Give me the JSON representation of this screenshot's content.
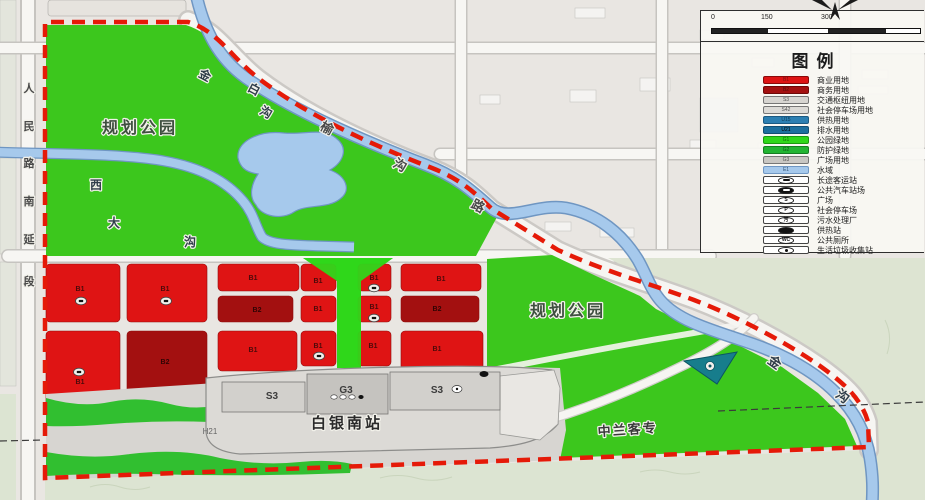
{
  "legend": {
    "title": "图例",
    "land_items": [
      {
        "code": "B1",
        "label": "商业用地",
        "color": "#dd1414",
        "border": "#8a0a0a",
        "text": "#7a1212"
      },
      {
        "code": "B2",
        "label": "商务用地",
        "color": "#a31010",
        "border": "#6d0808",
        "text": "#540a0a"
      },
      {
        "code": "S3",
        "label": "交通枢纽用地",
        "color": "#d7d5d1",
        "border": "#777777",
        "text": "#555555"
      },
      {
        "code": "S42",
        "label": "社会停车场用地",
        "color": "#dcdad6",
        "border": "#777777",
        "text": "#555555"
      },
      {
        "code": "U15",
        "label": "供热用地",
        "color": "#2c7fb2",
        "border": "#1b5a82",
        "text": "#0d3c58"
      },
      {
        "code": "U21",
        "label": "排水用地",
        "color": "#1d6f9e",
        "border": "#124e72",
        "text": "#0a3click"
      },
      {
        "code": "G1",
        "label": "公园绿地",
        "color": "#2fd71a",
        "border": "#1a9a10",
        "text": "#116a0a"
      },
      {
        "code": "G2",
        "label": "防护绿地",
        "color": "#22b432",
        "border": "#157d22",
        "text": "#0c5a16"
      },
      {
        "code": "G3",
        "label": "广场用地",
        "color": "#c9c7c3",
        "border": "#777777",
        "text": "#555555"
      },
      {
        "code": "E1",
        "label": "水域",
        "color": "#a6c9ec",
        "border": "#6f96c2",
        "text": "#335577"
      }
    ],
    "icon_items": [
      {
        "type": "bus",
        "glyph": "",
        "label": "长途客运站"
      },
      {
        "type": "busfill",
        "glyph": "",
        "label": "公共汽车站场"
      },
      {
        "type": "text",
        "glyph": "S",
        "label": "广场"
      },
      {
        "type": "text",
        "glyph": "P",
        "label": "社会停车场"
      },
      {
        "type": "text",
        "glyph": "污",
        "label": "污水处理厂"
      },
      {
        "type": "heatfill",
        "glyph": "",
        "label": "供热站"
      },
      {
        "type": "text",
        "glyph": "WC",
        "label": "公共厕所"
      },
      {
        "type": "dot",
        "glyph": "",
        "label": "生活垃圾收集站"
      }
    ]
  },
  "scale": {
    "ticks": [
      "0",
      "150",
      "300"
    ]
  },
  "map": {
    "park_label": "规划公园",
    "station_name": "白银南站",
    "corridor_code": "H21",
    "left_road": "人民路南延段",
    "diagonal_road": "榆沟路",
    "river_main": "金白沟",
    "river_west": "西大沟",
    "river_south": "金沟",
    "railway": "中兰客专",
    "station_blocks": [
      "S3",
      "G3",
      "S3"
    ],
    "blocks": [
      {
        "code": "B1",
        "x": 46,
        "y": 264,
        "w": 74,
        "h": 58,
        "lx": 80,
        "ly": 291,
        "icon": [
          81,
          301
        ]
      },
      {
        "code": "B1",
        "x": 46,
        "y": 331,
        "w": 74,
        "h": 78,
        "lx": 80,
        "ly": 384,
        "icon": [
          79,
          372
        ]
      },
      {
        "code": "B1",
        "x": 127,
        "y": 264,
        "w": 80,
        "h": 58,
        "lx": 165,
        "ly": 291,
        "icon": [
          166,
          301
        ]
      },
      {
        "code": "B2",
        "x": 127,
        "y": 331,
        "w": 80,
        "h": 78,
        "lx": 165,
        "ly": 364
      },
      {
        "code": "B1",
        "x": 218,
        "y": 264,
        "w": 81,
        "h": 27,
        "lx": 253,
        "ly": 280
      },
      {
        "code": "B2",
        "x": 218,
        "y": 296,
        "w": 75,
        "h": 26,
        "lx": 257,
        "ly": 312
      },
      {
        "code": "B1",
        "x": 218,
        "y": 331,
        "w": 79,
        "h": 40,
        "lx": 253,
        "ly": 352
      },
      {
        "code": "B1",
        "x": 301,
        "y": 264,
        "w": 35,
        "h": 27,
        "lx": 318,
        "ly": 283
      },
      {
        "code": "B1",
        "x": 301,
        "y": 296,
        "w": 35,
        "h": 26,
        "lx": 318,
        "ly": 311
      },
      {
        "code": "B1",
        "x": 301,
        "y": 331,
        "w": 35,
        "h": 35,
        "lx": 318,
        "ly": 348,
        "icon": [
          319,
          356
        ]
      },
      {
        "code": "B1",
        "x": 358,
        "y": 264,
        "w": 33,
        "h": 27,
        "lx": 374,
        "ly": 280,
        "icon": [
          374,
          288
        ]
      },
      {
        "code": "B1",
        "x": 358,
        "y": 296,
        "w": 33,
        "h": 26,
        "lx": 374,
        "ly": 309,
        "icon": [
          374,
          318
        ]
      },
      {
        "code": "B1",
        "x": 358,
        "y": 331,
        "w": 33,
        "h": 35,
        "lx": 373,
        "ly": 348
      },
      {
        "code": "B1",
        "x": 401,
        "y": 264,
        "w": 80,
        "h": 27,
        "lx": 441,
        "ly": 281
      },
      {
        "code": "B2",
        "x": 401,
        "y": 296,
        "w": 78,
        "h": 26,
        "lx": 437,
        "ly": 311
      },
      {
        "code": "B1",
        "x": 401,
        "y": 331,
        "w": 82,
        "h": 39,
        "lx": 437,
        "ly": 351
      }
    ]
  },
  "colors": {
    "park_green": "#3cc71d",
    "strip_green": "#2fd71a",
    "protect_green": "#31bf30",
    "water_fill": "#a6c9ec",
    "water_edge": "#6f96c2",
    "b1_red": "#df1414",
    "b2_dark_red": "#a31010",
    "boundary_red": "#e51a08",
    "facility_teal": "#177d8c"
  }
}
